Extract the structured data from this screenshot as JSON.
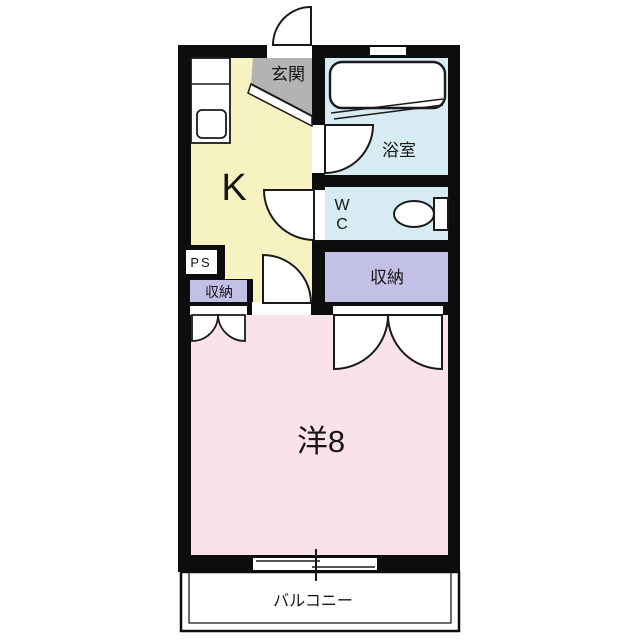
{
  "plan_title": "1K apartment floor plan",
  "colors": {
    "wall": "#0d0d0d",
    "kitchen": "#f7f2c2",
    "entrance": "#b3b2b4",
    "bathroom": "#d6ecf2",
    "wc": "#d6ecf2",
    "closet": "#c2c0e6",
    "room": "#f9e2eb",
    "fixture": "#ffffff",
    "text": "#161616"
  },
  "rooms": {
    "entrance": {
      "label": "玄関"
    },
    "kitchen": {
      "label": "K"
    },
    "bathroom": {
      "label": "浴室"
    },
    "wc": {
      "line1": "W",
      "line2": "C"
    },
    "pipe_space": {
      "label": "PS"
    },
    "closet_small": {
      "label": "収納"
    },
    "closet_large": {
      "label": "収納"
    },
    "western_room": {
      "label": "洋8"
    },
    "balcony": {
      "label": "バルコニー"
    }
  }
}
